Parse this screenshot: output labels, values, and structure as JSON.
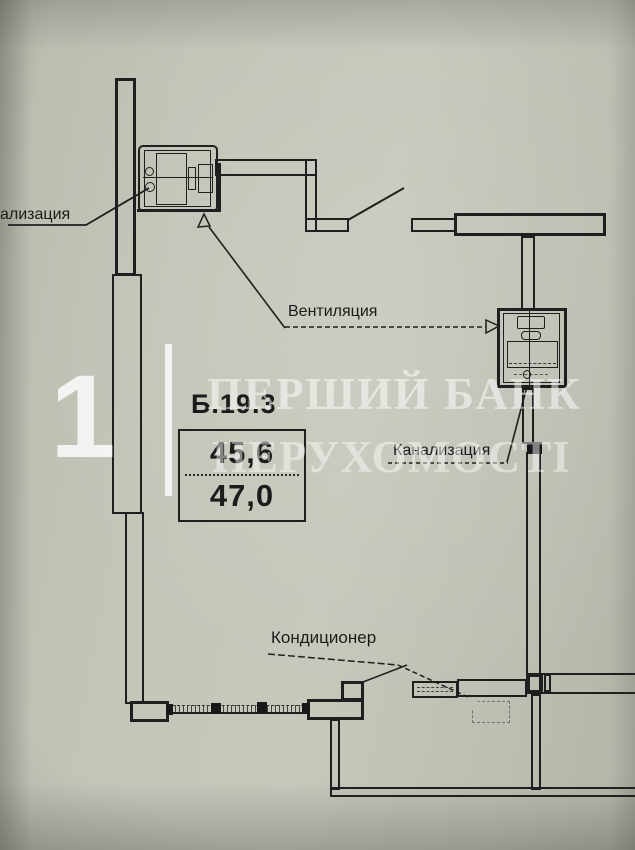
{
  "unit": {
    "code": "Б.19.3",
    "area_upper": "45,6",
    "area_lower": "47,0"
  },
  "annotations": {
    "sewerage_left": "ализация",
    "ventilation": "Вентиляция",
    "sewerage_right": "Канализация",
    "air_conditioner": "Кондиционер"
  },
  "watermark": {
    "digit": "1",
    "line1": "ПЕРШИЙ БАНК",
    "line2": "НЕРУХОМОСТІ"
  },
  "colors": {
    "paper": "#c2c5b8",
    "ink": "#1f1f1f",
    "watermark_text": "#ffffff"
  }
}
